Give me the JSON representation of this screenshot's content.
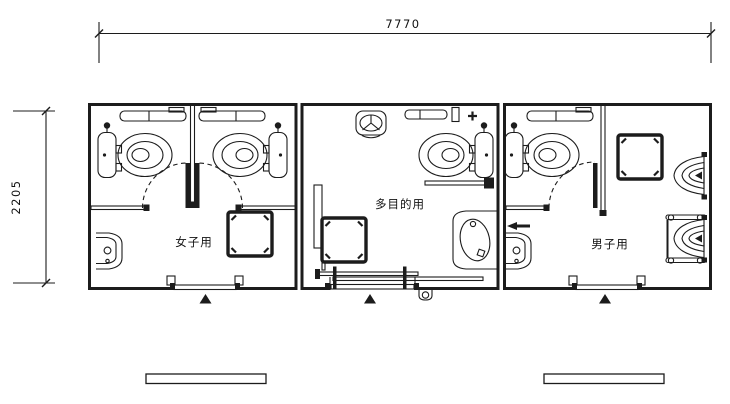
{
  "meta": {
    "drawing_type": "architectural-floor-plan"
  },
  "palette": {
    "background": "#ffffff",
    "line": "#1c1c1c",
    "text": "#111111"
  },
  "dimensions": {
    "overall_width": "7770",
    "overall_height": "2205"
  },
  "rooms": [
    {
      "id": "womens-toilet",
      "label": "女子用",
      "fixtures": [
        "toilet-stall",
        "toilet-stall",
        "shelf",
        "shelf",
        "swing-door",
        "swing-door",
        "wall-sink",
        "counter-unit",
        "entrance"
      ]
    },
    {
      "id": "multipurpose-toilet",
      "label": "多目的用",
      "fixtures": [
        "corner-basin",
        "shelf",
        "accessible-toilet",
        "grab-bar",
        "lavatory-sink",
        "counter-unit",
        "fold-down-bench",
        "sliding-door-entrance"
      ]
    },
    {
      "id": "mens-toilet",
      "label": "男子用",
      "fixtures": [
        "toilet-stall",
        "shelf",
        "swing-door",
        "counter-unit",
        "urinal",
        "urinal-with-grab-rails",
        "wall-sink",
        "entrance"
      ]
    }
  ]
}
